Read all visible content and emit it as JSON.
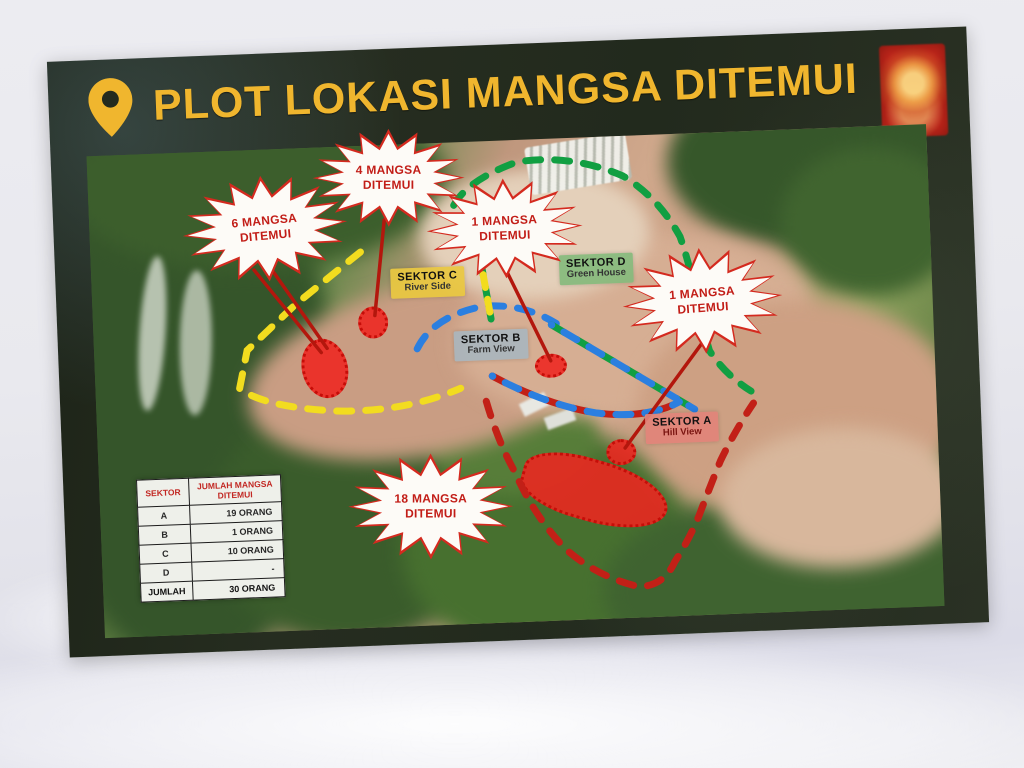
{
  "poster": {
    "title": "PLOT LOKASI MANGSA DITEMUI",
    "title_color": "#f0b62e",
    "background_color": "#232a1e",
    "pin_icon": "location-pin-icon",
    "emblem_icon": "agency-crest-icon",
    "emblem_color": "#c1271c"
  },
  "callouts": [
    {
      "line1": "6 MANGSA",
      "line2": "DITEMUI"
    },
    {
      "line1": "4 MANGSA",
      "line2": "DITEMUI"
    },
    {
      "line1": "1 MANGSA",
      "line2": "DITEMUI"
    },
    {
      "line1": "1 MANGSA",
      "line2": "DITEMUI"
    },
    {
      "line1": "18 MANGSA",
      "line2": "DITEMUI"
    }
  ],
  "sectors": [
    {
      "name": "SEKTOR C",
      "subtitle": "River Side",
      "label_color": "#e9c840",
      "boundary_color": "#f2dc1f"
    },
    {
      "name": "SEKTOR D",
      "subtitle": "Green House",
      "label_color": "#85ba7c",
      "boundary_color": "#119f42"
    },
    {
      "name": "SEKTOR B",
      "subtitle": "Farm View",
      "label_color": "#a9b5bd",
      "boundary_color": "#2b7fe0"
    },
    {
      "name": "SEKTOR A",
      "subtitle": "Hill View",
      "label_color": "#e2837a",
      "boundary_color": "#c22017"
    }
  ],
  "table": {
    "col_headers": [
      "SEKTOR",
      "JUMLAH MANGSA DITEMUI"
    ],
    "rows": [
      {
        "sector": "A",
        "count": "19 ORANG"
      },
      {
        "sector": "B",
        "count": "1 ORANG"
      },
      {
        "sector": "C",
        "count": "10 ORANG"
      },
      {
        "sector": "D",
        "count": "-"
      }
    ],
    "total": {
      "label": "JUMLAH",
      "value": "30 ORANG"
    }
  }
}
